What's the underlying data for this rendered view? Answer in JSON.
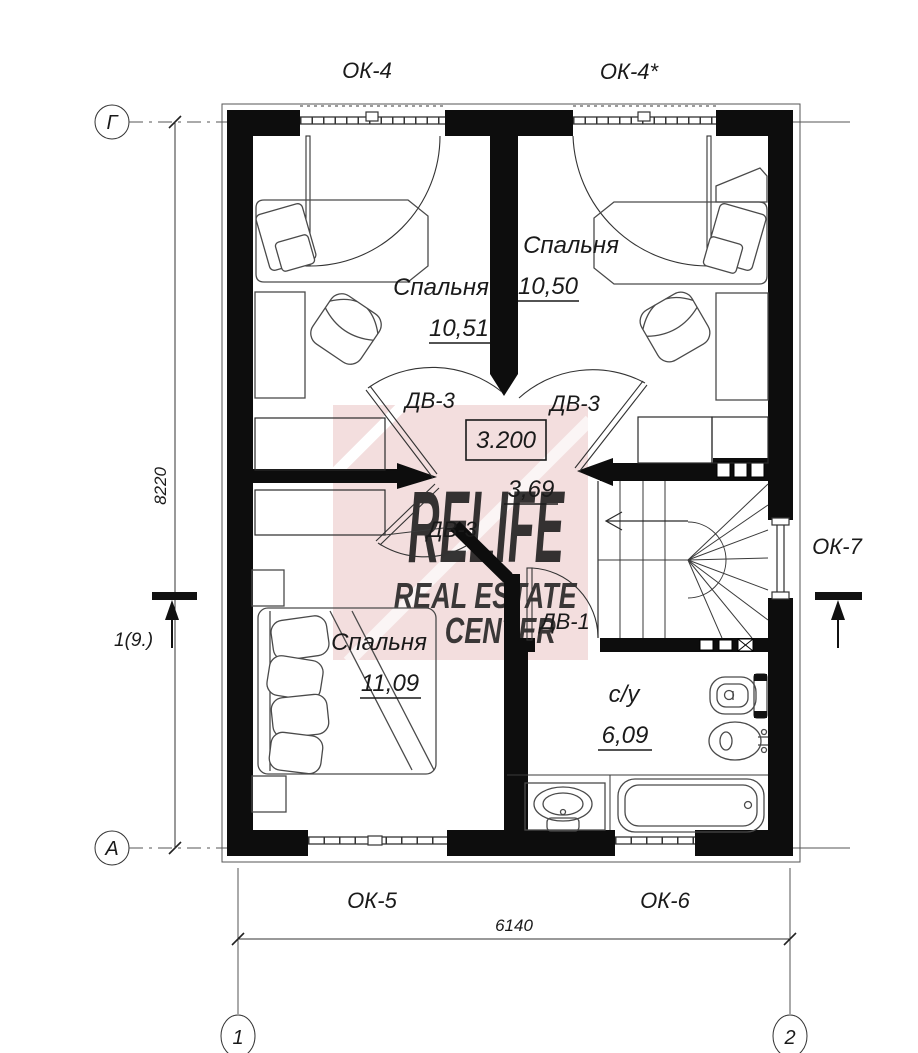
{
  "axes": {
    "row_top": "Г",
    "row_bottom": "А",
    "col_left": "1",
    "col_right": "2"
  },
  "dimensions": {
    "vertical_mm": "8220",
    "horizontal_mm": "6140"
  },
  "section_marker": {
    "label": "1(9.)"
  },
  "level_mark": {
    "value": "3.200"
  },
  "hallway": {
    "area": "3,69"
  },
  "windows": {
    "ok4": "ОК-4",
    "ok4s": "ОК-4*",
    "ok5": "ОК-5",
    "ok6": "ОК-6",
    "ok7": "ОК-7"
  },
  "doors": {
    "dv3": "ДВ-3",
    "dv1": "ДВ-1"
  },
  "rooms": {
    "bedroom_top_left": {
      "name": "Спальня",
      "area": "10,51"
    },
    "bedroom_top_right": {
      "name": "Спальня",
      "area": "10,50"
    },
    "bedroom_bottom": {
      "name": "Спальня",
      "area": "11,09"
    },
    "bathroom": {
      "name": "с/у",
      "area": "6,09"
    }
  },
  "watermark": {
    "brand": "RELIFE",
    "line2": "REAL ESTATE",
    "line3": "CENTER"
  },
  "colors": {
    "wall": "#0d0d0d",
    "watermark_pink": "#f3dede",
    "watermark_gray": "#dcdcdc"
  }
}
